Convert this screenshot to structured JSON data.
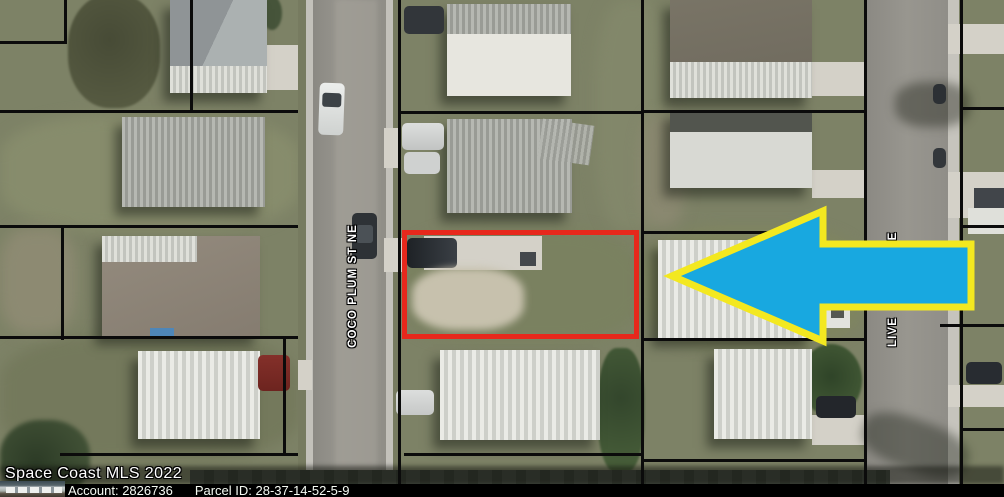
{
  "map": {
    "street_labels": {
      "left_street": "COCO PLUM ST NE",
      "right_street_partial_below_arrow": "LIVE",
      "right_street_partial_above_arrow": "E"
    }
  },
  "overlay": {
    "watermark": "Space Coast MLS 2022",
    "footer": {
      "account": "Account: 2826736",
      "parcel_id": "Parcel ID: 28-37-14-52-5-9"
    },
    "annotation_colors": {
      "arrow_fill": "#18a8e0",
      "arrow_outline": "#f3e820",
      "parcel_outline_red": "#e7281c",
      "footer_bg": "#000000",
      "footer_text": "#ffffff"
    }
  }
}
